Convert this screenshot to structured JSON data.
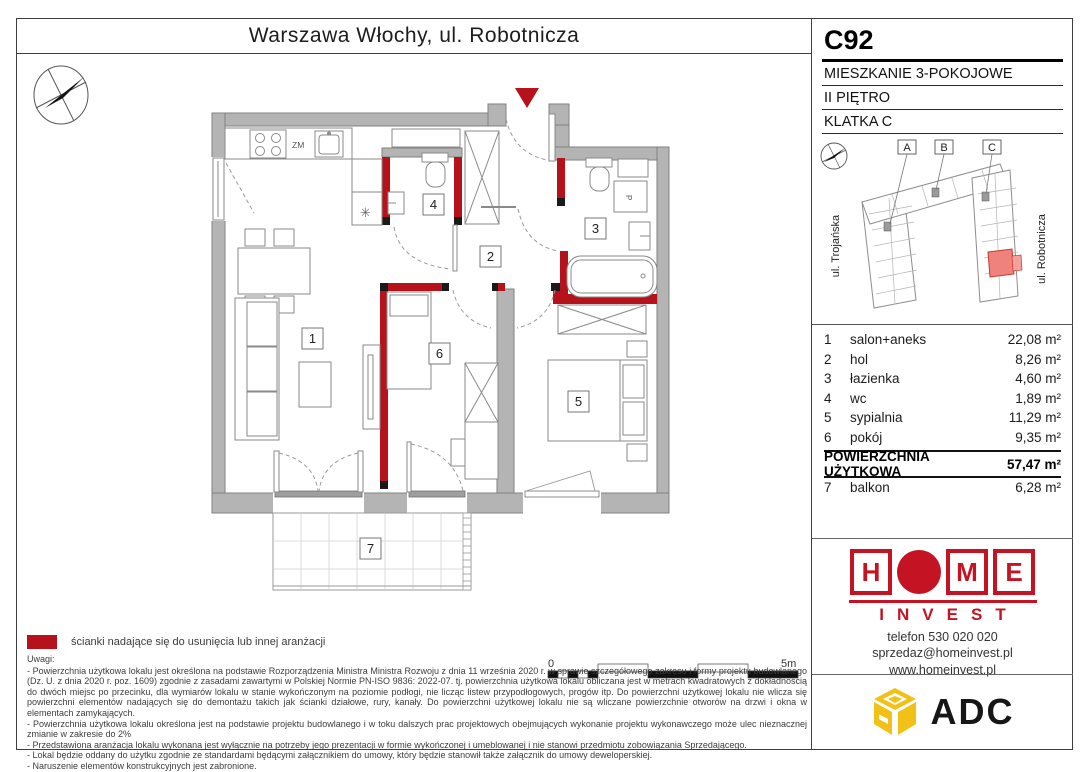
{
  "title": "Warszawa Włochy, ul. Robotnicza",
  "unit": {
    "code": "C92",
    "type": "MIESZKANIE 3-POKOJOWE",
    "floor": "II PIĘTRO",
    "staircase": "KLATKA C"
  },
  "sitemap": {
    "building_labels": [
      "A",
      "B",
      "C"
    ],
    "street_left": "ul. Trojańska",
    "street_right": "ul. Robotnicza"
  },
  "rooms": [
    {
      "num": "1",
      "name": "salon+aneks",
      "area": "22,08 m²"
    },
    {
      "num": "2",
      "name": "hol",
      "area": "8,26 m²"
    },
    {
      "num": "3",
      "name": "łazienka",
      "area": "4,60 m²"
    },
    {
      "num": "4",
      "name": "wc",
      "area": "1,89 m²"
    },
    {
      "num": "5",
      "name": "sypialnia",
      "area": "11,29 m²"
    },
    {
      "num": "6",
      "name": "pokój",
      "area": "9,35 m²"
    }
  ],
  "total": {
    "label": "POWIERZCHNIA UŻYTKOWA",
    "area": "57,47 m²"
  },
  "extra": {
    "num": "7",
    "name": "balkon",
    "area": "6,28 m²"
  },
  "plan": {
    "kitchen_label": "ZM",
    "washer_label": "P",
    "fridge_symbol": "✳",
    "scale_start": "0",
    "scale_end": "5m"
  },
  "legend": {
    "text": "ścianki nadające się do usunięcia lub innej aranżacji",
    "swatch_color": "#b5121b"
  },
  "notes": {
    "heading": "Uwagi:",
    "items": [
      "- Powierzchnia użytkowa lokalu jest określona na podstawie Rozporządzenia Ministra Ministra Rozwoju z dnia 11 września 2020 r. w sprawie szczegółowego zakresu i formy projektu budowlanego (Dz. U. z dnia 2020 r. poz. 1609) zgodnie z zasadami zawartymi w Polskiej Normie PN-ISO 9836: 2022-07. tj. powierzchnia użytkowa lokalu obliczana jest w metrach kwadratowych z dokładnością do dwóch miejsc po przecinku, dla wymiarów lokalu w stanie wykończonym na poziomie podłogi, nie licząc listew przypodłogowych, progów itp. Do powierzchni użytkowej lokalu nie wlicza się powierzchni elementów nadających się do demontażu takich jak ścianki działowe, rury, kanały. Do powierzchni użytkowej lokalu nie są wliczane powierzchnie otworów na drzwi i okna w elementach zamykających.",
      "- Powierzchnia użytkowa lokalu określona jest na podstawie projektu budowlanego i w toku dalszych prac projektowych obejmujących wykonanie projektu wykonawczego może ulec nieznacznej zmianie w zakresie do 2%",
      "- Przedstawiona aranżacja lokalu wykonana jest wyłącznie na potrzeby jego prezentacji w formie wykończonej i umeblowanej i nie stanowi przedmiotu zobowiązania Sprzedającego.",
      "- Lokal będzie oddany do użytku zgodnie ze standardami będącymi załącznikiem do umowy, który będzie stanowił także załącznik do umowy deweloperskiej.",
      "- Naruszenie elementów konstrukcyjnych jest zabronione."
    ]
  },
  "brand": {
    "home": {
      "letter_h": "H",
      "letter_m": "M",
      "letter_e": "E",
      "sub": "INVEST",
      "phone": "telefon 530 020 020",
      "email": "sprzedaz@homeinvest.pl",
      "web": "www.homeinvest.pl",
      "red": "#c41424"
    },
    "adc": {
      "name": "ADC",
      "yellow": "#f2c117"
    }
  },
  "colors": {
    "wall_gray": "#b4b4b4",
    "partition_red": "#b5121b",
    "site_unit_red": "#f0827e"
  }
}
